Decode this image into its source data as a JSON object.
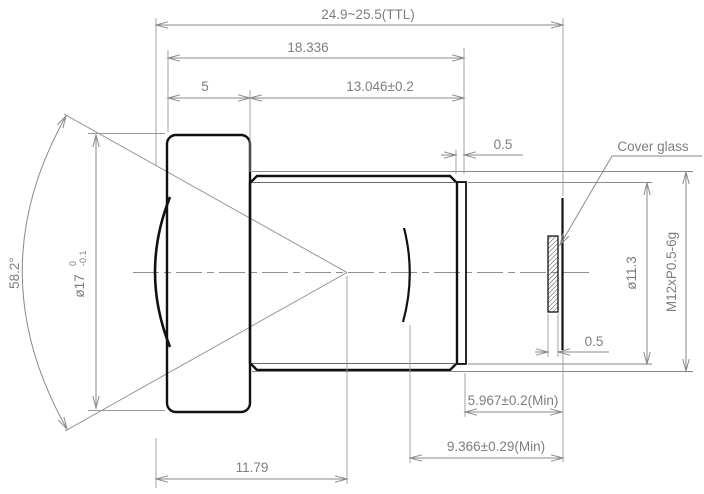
{
  "colors": {
    "outline": "#111111",
    "dimension": "#8a8a8a",
    "background": "#ffffff"
  },
  "labels": {
    "cover_glass": "Cover glass",
    "ttl": "24.9~25.5(TTL)",
    "front_face_to_rear": "18.336",
    "flange_width": "5",
    "barrel_length": "13.046±0.2",
    "rear_step": "0.5",
    "glass_thickness": "0.5",
    "front_diameter": "ø17",
    "front_diameter_tol_upper": "0",
    "front_diameter_tol_lower": "-0.1",
    "fov_angle": "58.2°",
    "rear_opening_diameter": "ø11.3",
    "thread_spec": "M12xP0.5-6g",
    "rear_face_to_image": "5.967±0.2(Min)",
    "back_focal_distance": "9.366±0.29(Min)",
    "vertex_to_stop": "11.79"
  }
}
